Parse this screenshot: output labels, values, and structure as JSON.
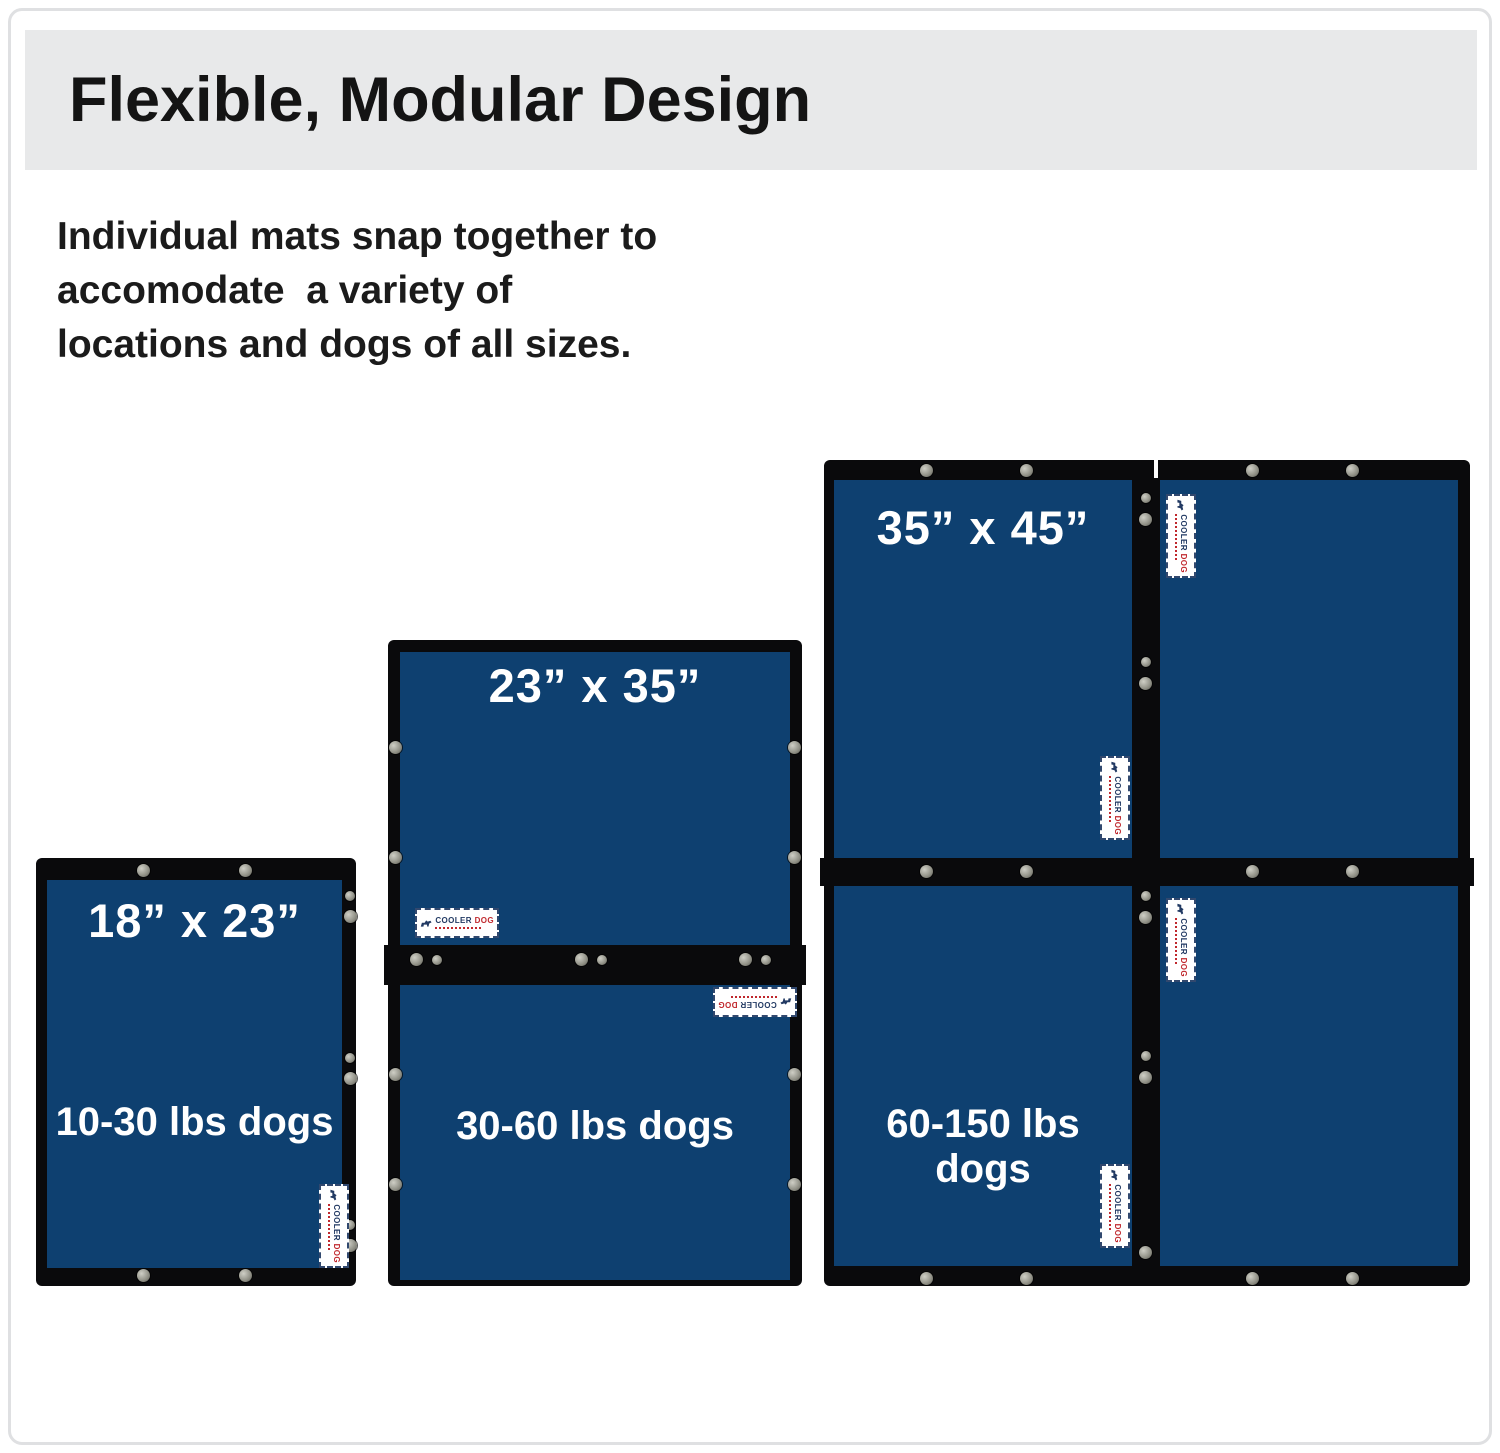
{
  "header": {
    "title": "Flexible, Modular Design"
  },
  "intro": {
    "line1": "Individual mats snap together to",
    "line2": "accomodate  a variety of",
    "line3": "locations and dogs of all sizes."
  },
  "groups": {
    "small": {
      "size_label": "18” x 23”",
      "weight_label": "10-30 lbs dogs"
    },
    "medium": {
      "size_label": "23” x 35”",
      "weight_label": "30-60 lbs dogs"
    },
    "large": {
      "size_label": "35” x 45”",
      "weight_label": "60-150 lbs dogs"
    }
  },
  "brand": {
    "name_first": "COOLER",
    "name_second": "DOG"
  },
  "colors": {
    "mat_blue": "#0e4070",
    "frame_black": "#0a0a0c",
    "banner_gray": "#e8e9ea",
    "brand_navy": "#223a63",
    "brand_red": "#c0282d"
  }
}
